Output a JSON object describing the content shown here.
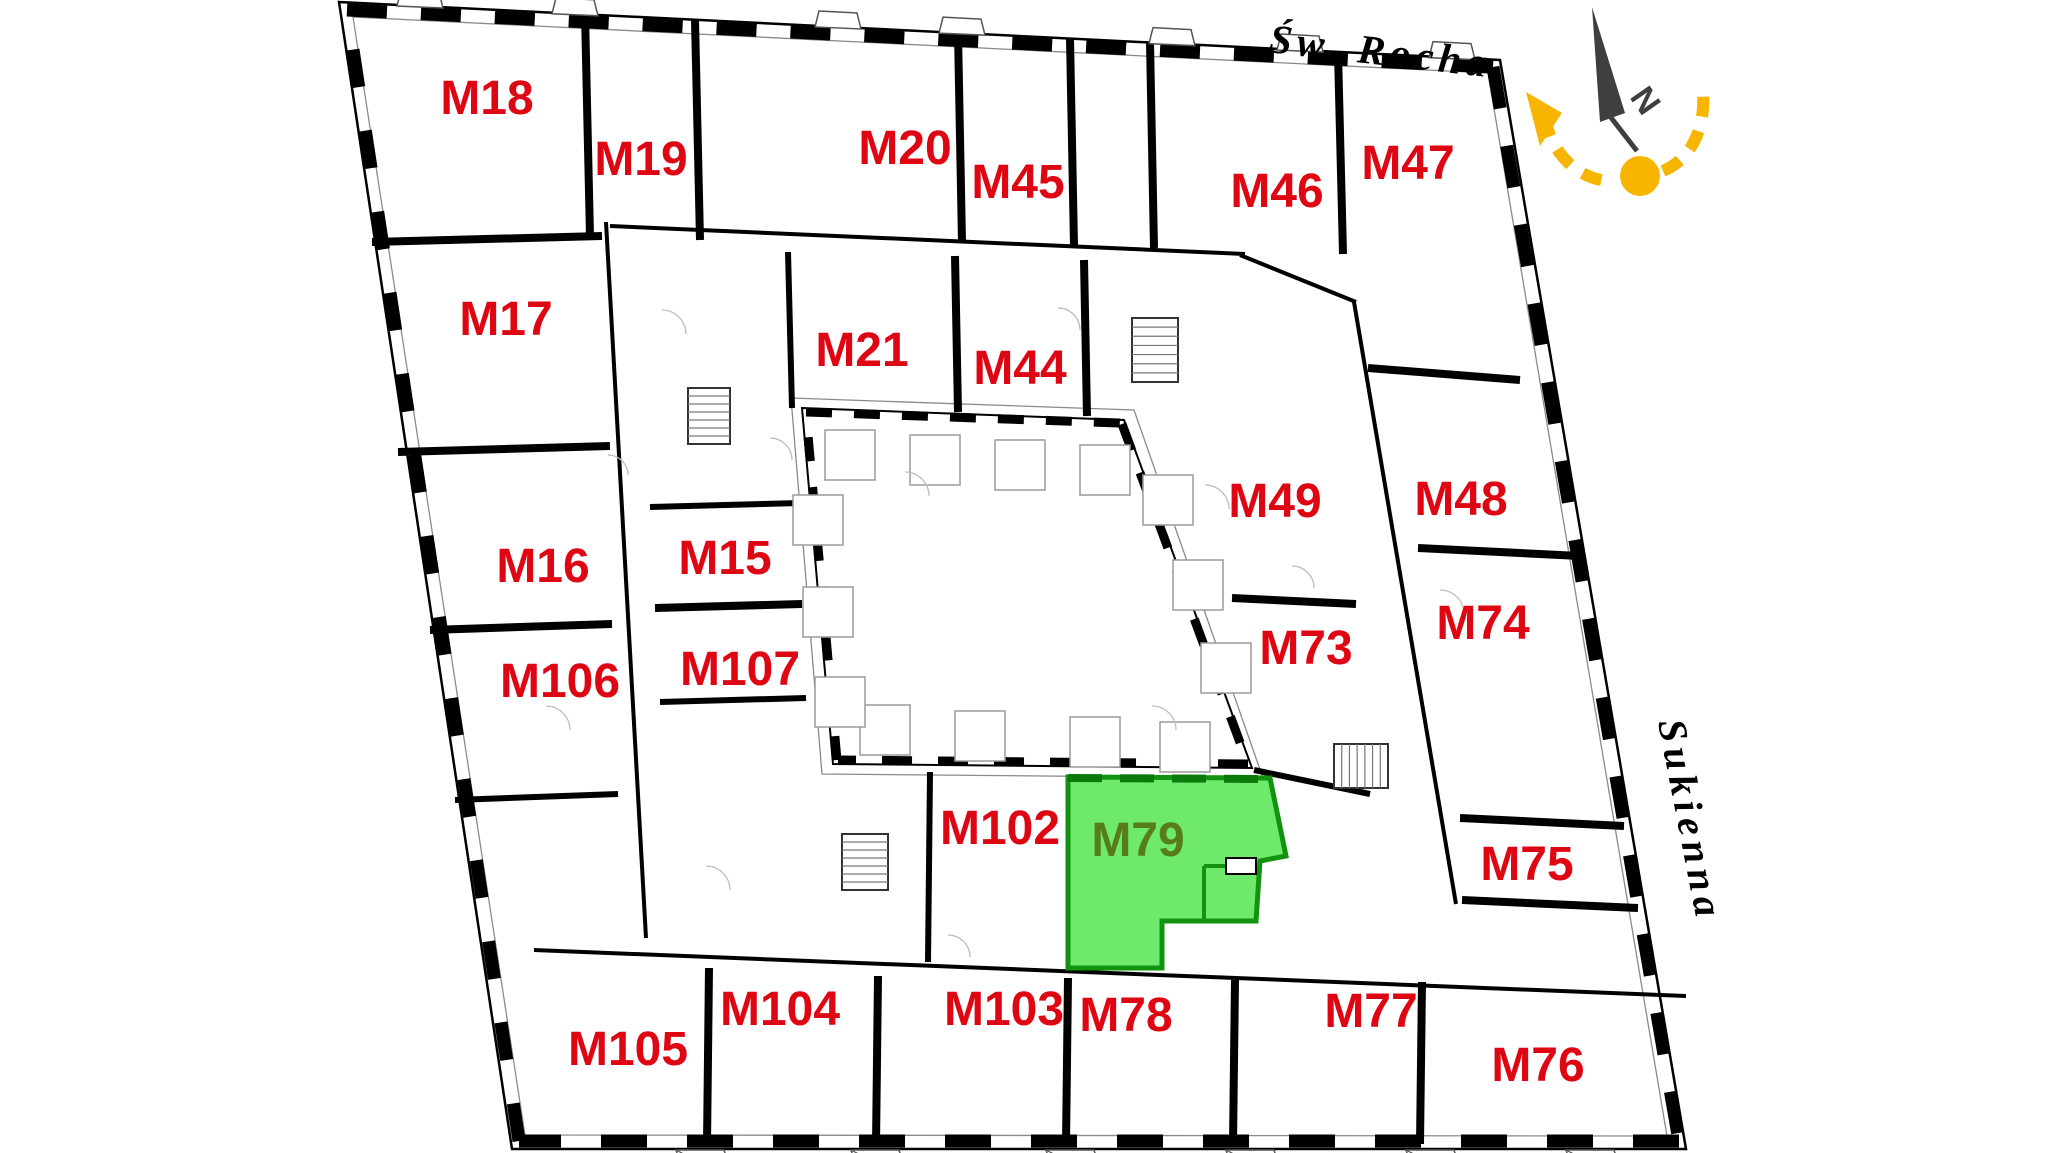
{
  "plan": {
    "title_hint": "apartment floor plan",
    "streets": {
      "top": "Św. Rocha",
      "right": "Sukienna"
    },
    "compass": {
      "north_label": "N"
    },
    "colors": {
      "apartment_label": "#df0613",
      "highlight_fill": "#6ee96c",
      "highlight_border": "#119310",
      "highlight_label": "#567d1a",
      "compass_needle": "#3f3f3f",
      "rotation_arrow": "#f7b500",
      "walls": "#000000"
    },
    "highlighted_apartment": "M79",
    "apartments": [
      {
        "id": "M18",
        "x": 487,
        "y": 97
      },
      {
        "id": "M19",
        "x": 641,
        "y": 158
      },
      {
        "id": "M20",
        "x": 905,
        "y": 147
      },
      {
        "id": "M45",
        "x": 1018,
        "y": 181
      },
      {
        "id": "M46",
        "x": 1277,
        "y": 190
      },
      {
        "id": "M47",
        "x": 1408,
        "y": 162
      },
      {
        "id": "M17",
        "x": 506,
        "y": 318
      },
      {
        "id": "M21",
        "x": 862,
        "y": 349
      },
      {
        "id": "M44",
        "x": 1020,
        "y": 367
      },
      {
        "id": "M49",
        "x": 1275,
        "y": 500
      },
      {
        "id": "M48",
        "x": 1461,
        "y": 498
      },
      {
        "id": "M16",
        "x": 543,
        "y": 565
      },
      {
        "id": "M15",
        "x": 725,
        "y": 557
      },
      {
        "id": "M74",
        "x": 1483,
        "y": 622
      },
      {
        "id": "M73",
        "x": 1306,
        "y": 647
      },
      {
        "id": "M106",
        "x": 560,
        "y": 680
      },
      {
        "id": "M107",
        "x": 740,
        "y": 668
      },
      {
        "id": "M102",
        "x": 1000,
        "y": 827
      },
      {
        "id": "M79",
        "x": 1138,
        "y": 839,
        "highlight": true
      },
      {
        "id": "M75",
        "x": 1527,
        "y": 863
      },
      {
        "id": "M104",
        "x": 780,
        "y": 1008
      },
      {
        "id": "M103",
        "x": 1004,
        "y": 1008
      },
      {
        "id": "M78",
        "x": 1126,
        "y": 1014
      },
      {
        "id": "M77",
        "x": 1371,
        "y": 1010
      },
      {
        "id": "M105",
        "x": 628,
        "y": 1048
      },
      {
        "id": "M76",
        "x": 1538,
        "y": 1064
      }
    ]
  }
}
